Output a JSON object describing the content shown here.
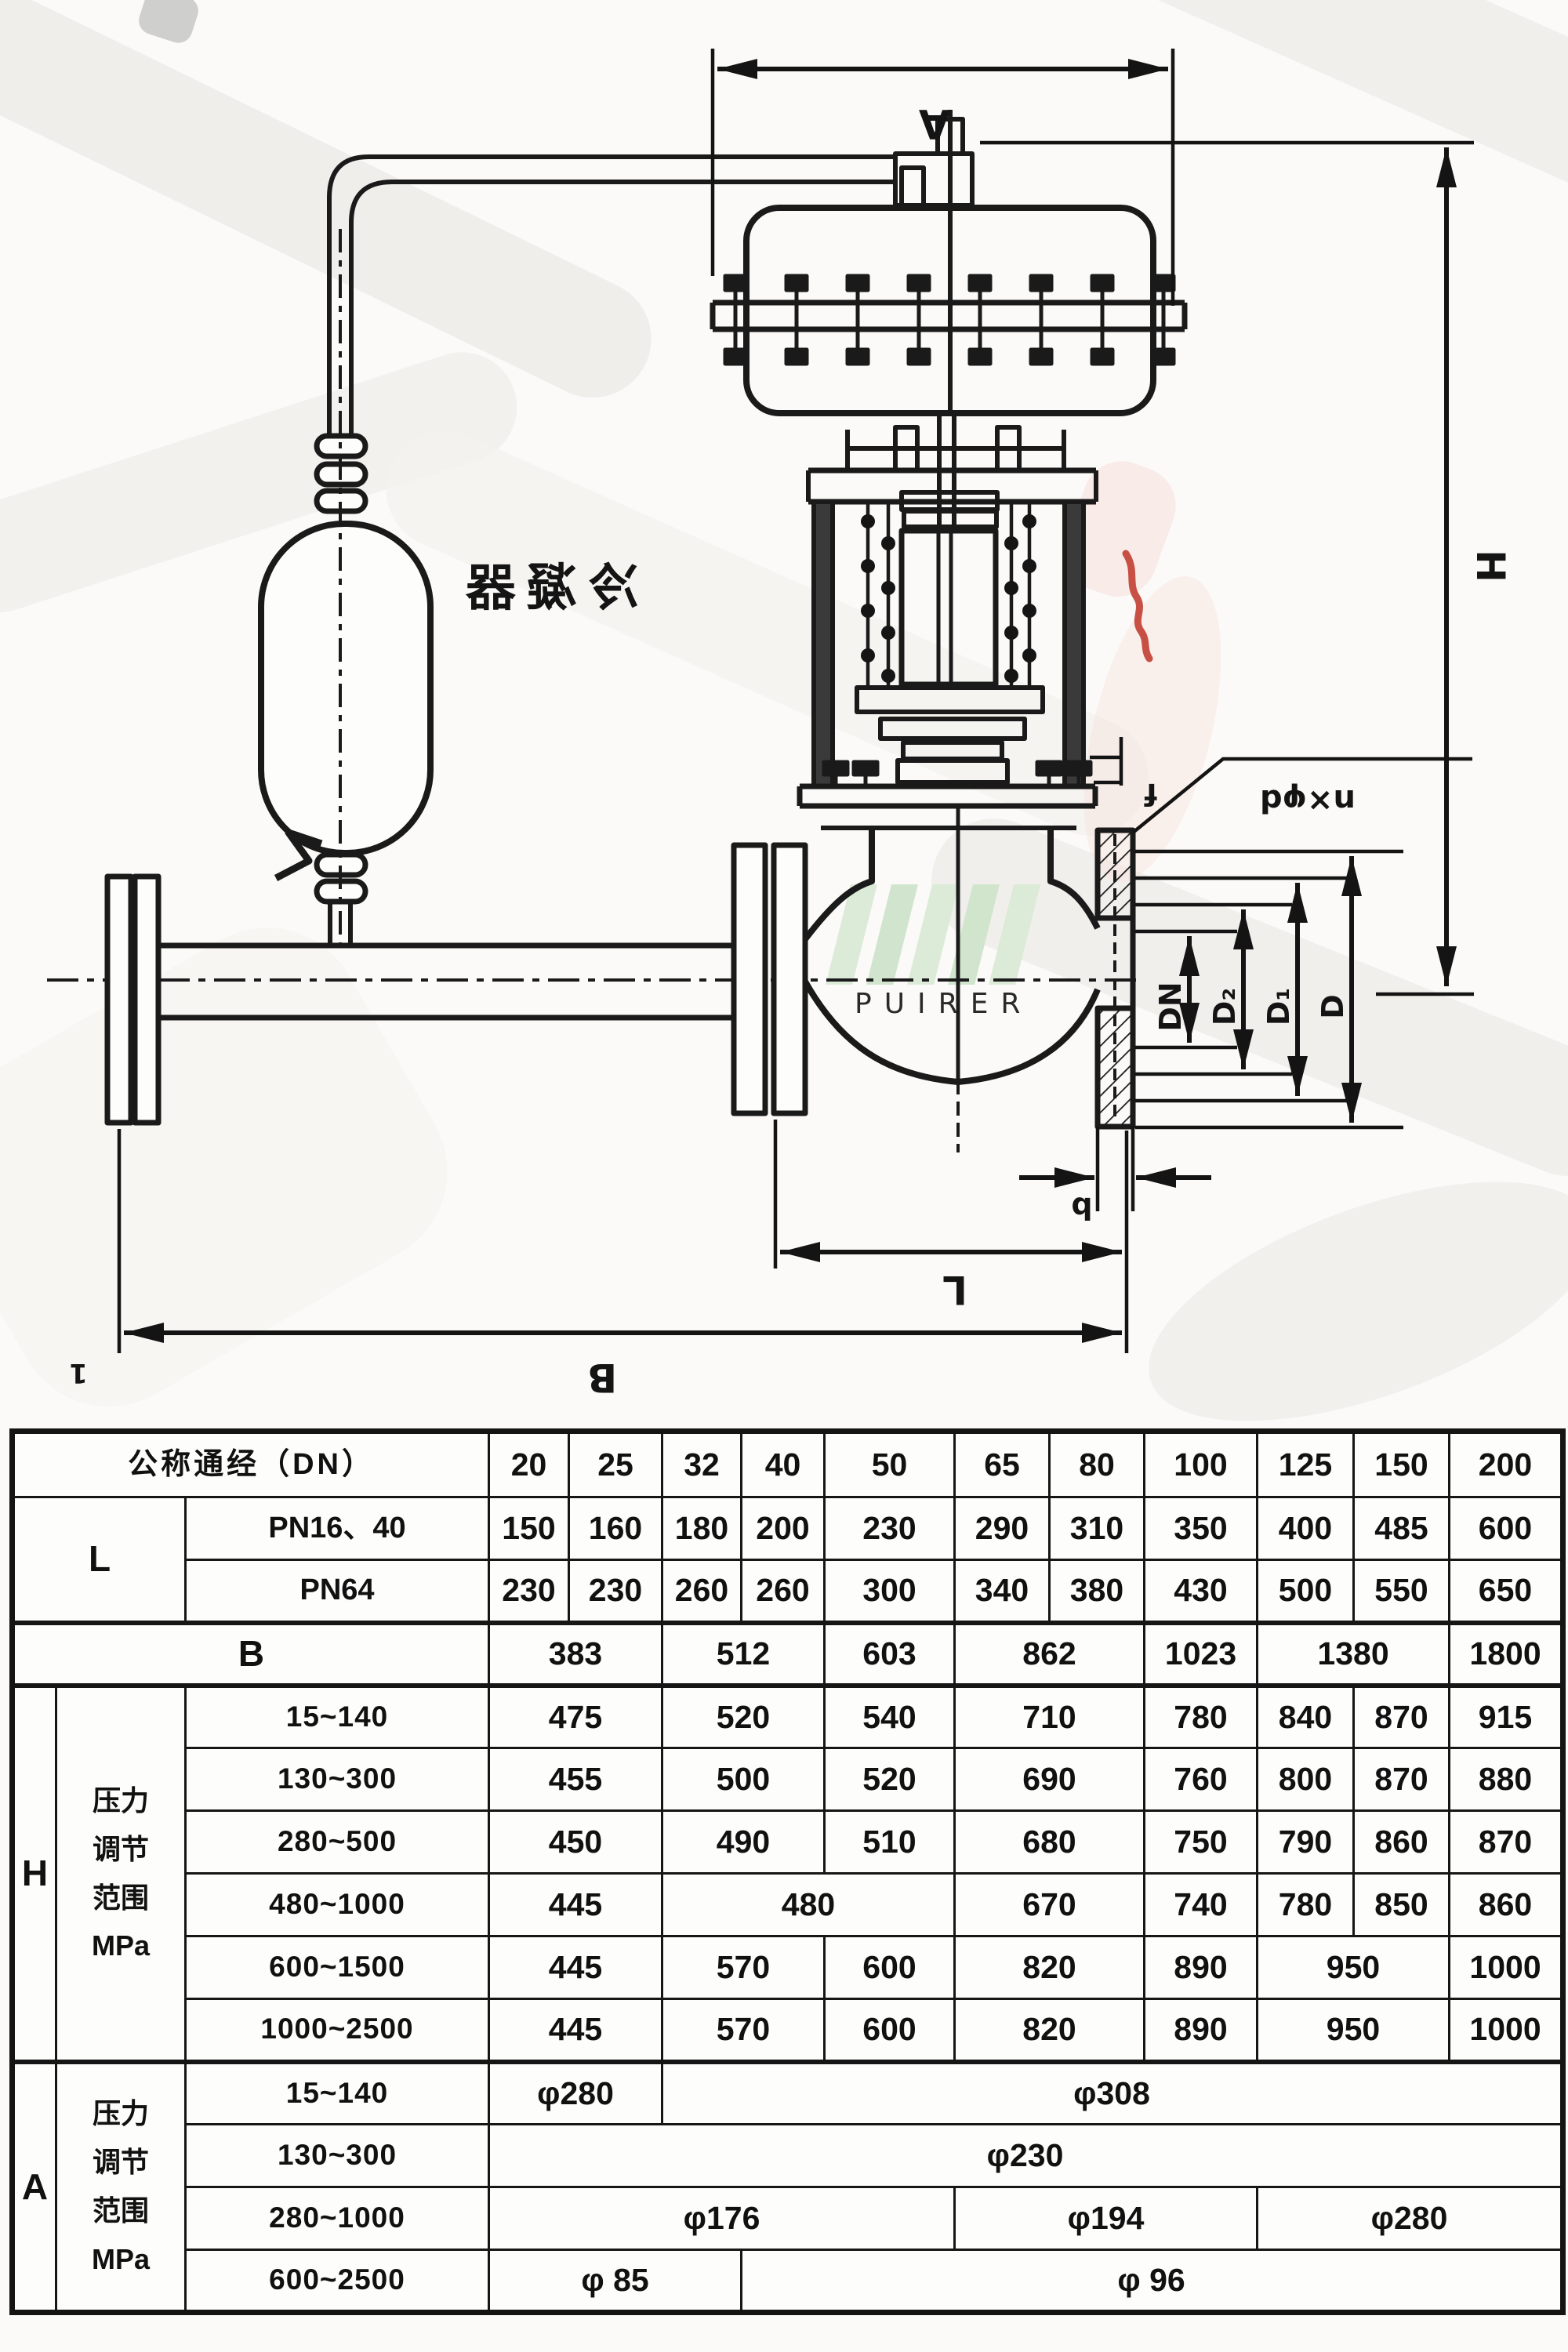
{
  "diagram": {
    "condenser_label": "冷凝器",
    "watermark_text": "PUIRER",
    "part_note": "1",
    "dim_labels": {
      "actuator_width": "A",
      "total_height": "H",
      "bolt_holes": "n×φd",
      "raised_face": "f",
      "flange_thickness": "b",
      "nominal_bore": "DN",
      "raised_face_dia": "D₂",
      "bolt_circle_dia": "D₁",
      "flange_outer_dia": "D",
      "face_to_face": "L",
      "overall_width": "B"
    }
  },
  "colors": {
    "line": "#1a1a1a",
    "red_mark": "#c0392b",
    "watermark_green": "#d9ead6",
    "watermark_gray": "#c9c9c9",
    "paper": "#fbfaf8"
  },
  "table": {
    "rows": [
      {
        "cells": [
          {
            "t": "公称通经（DN）",
            "c": 3,
            "cls": "hdr"
          },
          {
            "t": "20"
          },
          {
            "t": "25"
          },
          {
            "t": "32"
          },
          {
            "t": "40"
          },
          {
            "t": "50"
          },
          {
            "t": "65"
          },
          {
            "t": "80"
          },
          {
            "t": "100"
          },
          {
            "t": "125"
          },
          {
            "t": "150"
          },
          {
            "t": "200"
          }
        ]
      },
      {
        "cells": [
          {
            "t": "L",
            "c": 2,
            "r": 2,
            "cls": "big"
          },
          {
            "t": "PN16、40",
            "cls": "sub"
          },
          {
            "t": "150"
          },
          {
            "t": "160"
          },
          {
            "t": "180"
          },
          {
            "t": "200"
          },
          {
            "t": "230"
          },
          {
            "t": "290"
          },
          {
            "t": "310"
          },
          {
            "t": "350"
          },
          {
            "t": "400"
          },
          {
            "t": "485"
          },
          {
            "t": "600"
          }
        ]
      },
      {
        "cells": [
          {
            "t": "PN64",
            "cls": "sub"
          },
          {
            "t": "230"
          },
          {
            "t": "230"
          },
          {
            "t": "260"
          },
          {
            "t": "260"
          },
          {
            "t": "300"
          },
          {
            "t": "340"
          },
          {
            "t": "380"
          },
          {
            "t": "430"
          },
          {
            "t": "500"
          },
          {
            "t": "550"
          },
          {
            "t": "650"
          }
        ]
      },
      {
        "cls": "sep",
        "cells": [
          {
            "t": "B",
            "c": 3,
            "cls": "big"
          },
          {
            "t": "383",
            "c": 2
          },
          {
            "t": "512",
            "c": 2
          },
          {
            "t": "603"
          },
          {
            "t": "862",
            "c": 2
          },
          {
            "t": "1023"
          },
          {
            "t": "1380",
            "c": 2
          },
          {
            "t": "1800"
          }
        ]
      },
      {
        "cls": "sep",
        "cells": [
          {
            "t": "H",
            "r": 6,
            "cls": "big"
          },
          {
            "t": "压力\n调节\n范围\nMPa",
            "r": 6,
            "cls": "stack"
          },
          {
            "t": "15~140",
            "cls": "rng"
          },
          {
            "t": "475",
            "c": 2
          },
          {
            "t": "520",
            "c": 2
          },
          {
            "t": "540"
          },
          {
            "t": "710",
            "c": 2
          },
          {
            "t": "780"
          },
          {
            "t": "840"
          },
          {
            "t": "870"
          },
          {
            "t": "915"
          }
        ]
      },
      {
        "cells": [
          {
            "t": "130~300",
            "cls": "rng"
          },
          {
            "t": "455",
            "c": 2
          },
          {
            "t": "500",
            "c": 2
          },
          {
            "t": "520"
          },
          {
            "t": "690",
            "c": 2
          },
          {
            "t": "760"
          },
          {
            "t": "800"
          },
          {
            "t": "870"
          },
          {
            "t": "880"
          }
        ]
      },
      {
        "cells": [
          {
            "t": "280~500",
            "cls": "rng"
          },
          {
            "t": "450",
            "c": 2
          },
          {
            "t": "490",
            "c": 2
          },
          {
            "t": "510"
          },
          {
            "t": "680",
            "c": 2
          },
          {
            "t": "750"
          },
          {
            "t": "790"
          },
          {
            "t": "860"
          },
          {
            "t": "870"
          }
        ]
      },
      {
        "cells": [
          {
            "t": "480~1000",
            "cls": "rng"
          },
          {
            "t": "445",
            "c": 2
          },
          {
            "t": "480",
            "c": 3
          },
          {
            "t": "670",
            "c": 2
          },
          {
            "t": "740"
          },
          {
            "t": "780"
          },
          {
            "t": "850"
          },
          {
            "t": "860"
          }
        ]
      },
      {
        "cells": [
          {
            "t": "600~1500",
            "cls": "rng"
          },
          {
            "t": "445",
            "c": 2
          },
          {
            "t": "570",
            "c": 2
          },
          {
            "t": "600"
          },
          {
            "t": "820",
            "c": 2
          },
          {
            "t": "890"
          },
          {
            "t": "950",
            "c": 2
          },
          {
            "t": "1000"
          }
        ]
      },
      {
        "cells": [
          {
            "t": "1000~2500",
            "cls": "rng"
          },
          {
            "t": "445",
            "c": 2
          },
          {
            "t": "570",
            "c": 2
          },
          {
            "t": "600"
          },
          {
            "t": "820",
            "c": 2
          },
          {
            "t": "890"
          },
          {
            "t": "950",
            "c": 2
          },
          {
            "t": "1000"
          }
        ]
      },
      {
        "cls": "sep",
        "cells": [
          {
            "t": "A",
            "r": 4,
            "cls": "big"
          },
          {
            "t": "压力\n调节\n范围\nMPa",
            "r": 4,
            "cls": "stack"
          },
          {
            "t": "15~140",
            "cls": "rng"
          },
          {
            "t": "φ280",
            "c": 2
          },
          {
            "t": "φ308",
            "c": 9
          }
        ]
      },
      {
        "cells": [
          {
            "t": "130~300",
            "cls": "rng"
          },
          {
            "t": "φ230",
            "c": 11
          }
        ]
      },
      {
        "cells": [
          {
            "t": "280~1000",
            "cls": "rng"
          },
          {
            "t": "φ176",
            "c": 5
          },
          {
            "t": "φ194",
            "c": 3
          },
          {
            "t": "φ280",
            "c": 3
          }
        ]
      },
      {
        "cells": [
          {
            "t": "600~2500",
            "cls": "rng"
          },
          {
            "t": "φ 85",
            "c": 3
          },
          {
            "t": "φ 96",
            "c": 8
          }
        ]
      }
    ]
  }
}
